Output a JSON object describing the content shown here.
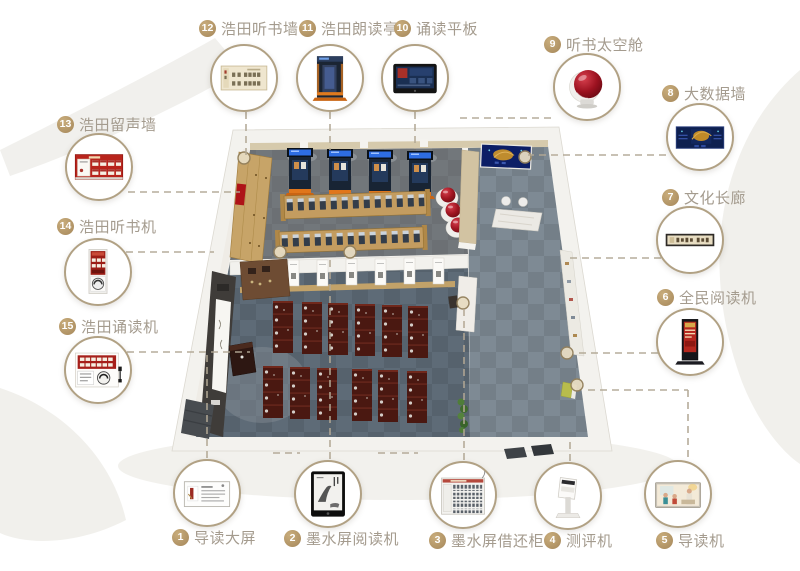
{
  "diagram_title": "smart reading space floor plan with numbered equipment callouts",
  "colors": {
    "accent_gold": "#b5975f",
    "label_text": "#a49b8e",
    "circle_border": "#b1a184",
    "dashed_line": "#b2a895",
    "pod_red": "#a11622",
    "kiosk_blue": "#182434",
    "carpet_gray": "#5e6b77"
  },
  "callouts": [
    {
      "num": "1",
      "label": "导读大屏"
    },
    {
      "num": "2",
      "label": "墨水屏阅读机"
    },
    {
      "num": "3",
      "label": "墨水屏借还柜"
    },
    {
      "num": "4",
      "label": "测评机"
    },
    {
      "num": "5",
      "label": "导读机"
    },
    {
      "num": "6",
      "label": "全民阅读机"
    },
    {
      "num": "7",
      "label": "文化长廊"
    },
    {
      "num": "8",
      "label": "大数据墙"
    },
    {
      "num": "9",
      "label": "听书太空舱"
    },
    {
      "num": "10",
      "label": "诵读平板"
    },
    {
      "num": "11",
      "label": "浩田朗读亭"
    },
    {
      "num": "12",
      "label": "浩田听书墙"
    },
    {
      "num": "13",
      "label": "浩田留声墙"
    },
    {
      "num": "14",
      "label": "浩田听书机"
    },
    {
      "num": "15",
      "label": "浩田诵读机"
    }
  ],
  "floorplan_features": [
    "listening-wall",
    "reading-booths",
    "study-tables",
    "space-pods",
    "data-screen",
    "reception-desk",
    "scroll-banners",
    "classroom-desks",
    "lecture-podium",
    "culture-wall-panel",
    "entrance-mats",
    "plants"
  ]
}
